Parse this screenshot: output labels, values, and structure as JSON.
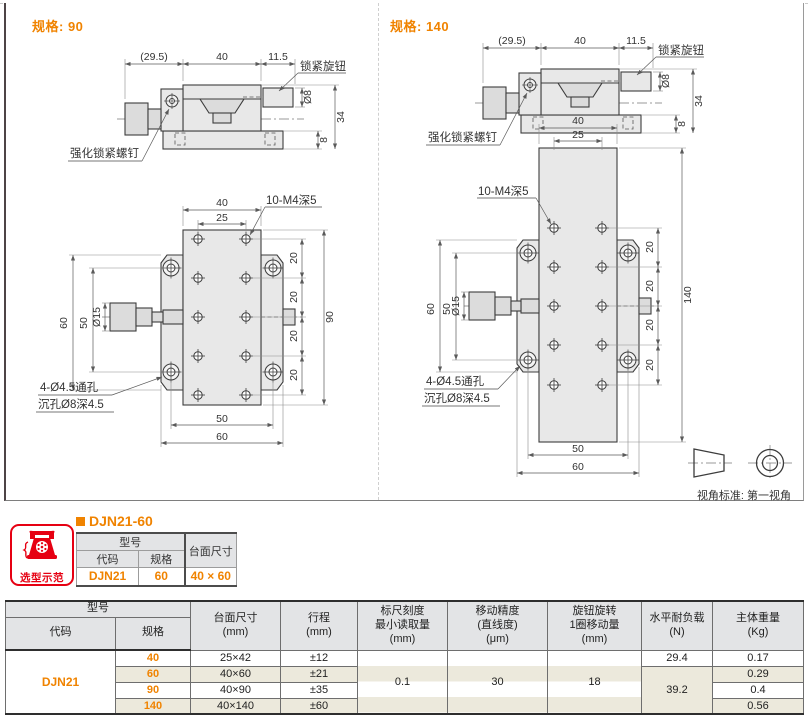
{
  "panels": {
    "left": {
      "spec_label": "规格: 90",
      "plan_length": "90"
    },
    "right": {
      "spec_label": "规格: 140",
      "plan_length": "140"
    }
  },
  "drawing_labels": {
    "knob_width": "(29.5)",
    "table_width": "40",
    "lock_offset": "11.5",
    "lock_knob": "锁紧旋钮",
    "lock_dia": "Ø8",
    "overall_height": "34",
    "base_height": "8",
    "reinforced_screw": "强化锁紧螺钉",
    "plan_width": "40",
    "hole_cols_span": "25",
    "tap_note": "10-M4深5",
    "hole_pitch": "20",
    "knob_dia": "Ø15",
    "rail_span": "60",
    "hole_span": "50",
    "thru_hole_note": "4-Ø4.5通孔",
    "cbore_note": "沉孔Ø8深4.5",
    "base_hole_span": "50",
    "base_width": "60"
  },
  "projection": {
    "caption": "视角标准: 第一视角"
  },
  "selection": {
    "badge_label": "选型示范",
    "title": "DJN21-60",
    "table": {
      "model_header": "型号",
      "code_header": "代码",
      "spec_header": "规格",
      "size_header": "台面尺寸",
      "code": "DJN21",
      "spec": "60",
      "size": "40 × 60"
    }
  },
  "spec_table": {
    "headers": {
      "model": "型号",
      "code": "代码",
      "spec": "规格",
      "table_size": "台面尺寸\n(mm)",
      "stroke": "行程\n(mm)",
      "scale": "标尺刻度\n最小读取量\n(mm)",
      "accuracy": "移动精度\n(直线度)\n(μm)",
      "per_turn": "旋钮旋转\n1圈移动量\n(mm)",
      "load": "水平耐负载\n(N)",
      "weight": "主体重量\n(Kg)"
    },
    "code": "DJN21",
    "merged": {
      "scale": "0.1",
      "accuracy": "30",
      "per_turn": "18",
      "load_40": "29.4",
      "load_rest": "39.2"
    },
    "rows": [
      {
        "spec": "40",
        "size": "25×42",
        "stroke": "±12",
        "weight": "0.17"
      },
      {
        "spec": "60",
        "size": "40×60",
        "stroke": "±21",
        "weight": "0.29"
      },
      {
        "spec": "90",
        "size": "40×90",
        "stroke": "±35",
        "weight": "0.4"
      },
      {
        "spec": "140",
        "size": "40×140",
        "stroke": "±60",
        "weight": "0.56"
      }
    ]
  },
  "colors": {
    "accent": "#f08300",
    "badge_red": "#e60012",
    "row_alt": "#ece9dc",
    "header_bg": "#e3e4e6"
  }
}
